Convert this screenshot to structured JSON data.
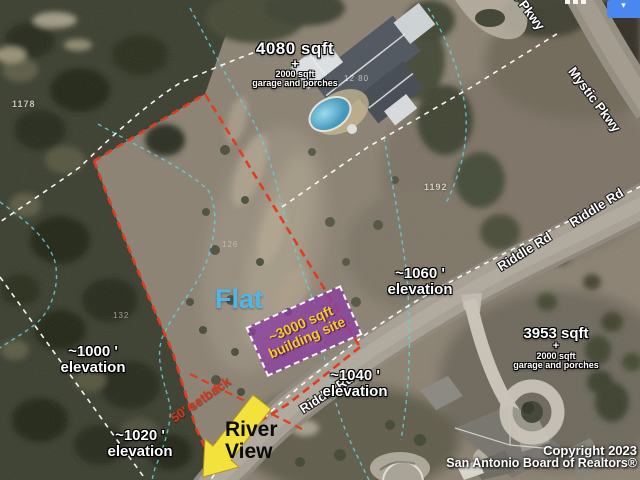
{
  "map": {
    "area_labels": {
      "north_house": {
        "sqft": "4080 sqft",
        "plus": "+",
        "extra1": "2000 sqft",
        "extra2": "garage and porches"
      },
      "south_house": {
        "sqft": "3953 sqft",
        "plus": "+",
        "extra1": "2000 sqft",
        "extra2": "garage and porches"
      }
    },
    "site_labels": {
      "flat": "Flat",
      "building_site_line1": "~3000 sqft",
      "building_site_line2": "building site",
      "setback": "50' setback",
      "river_view_line1": "River",
      "river_view_line2": "View"
    },
    "elevation_labels": {
      "e1060": {
        "value": "~1060 '",
        "word": "elevation"
      },
      "e1040": {
        "value": "~1040 '",
        "word": "elevation"
      },
      "e1000": {
        "value": "~1000 '",
        "word": "elevation"
      },
      "e1020": {
        "value": "~1020 '",
        "word": "elevation"
      }
    },
    "parcel_numbers": {
      "p1178": "1178",
      "p1192": "1192",
      "p126": "126",
      "p132": "132"
    },
    "house_number": "12 80",
    "road_labels": {
      "riddle1": "Riddle Rd",
      "riddle2": "Riddle Rd",
      "riddle3": "Riddle Rd",
      "mystic1": "Mystic Pkwy",
      "mystic2": "Mystic Pkwy"
    },
    "copyright": {
      "line1": "Copyright 2023",
      "line2": "San Antonio Board of Realtors®"
    },
    "colors": {
      "boundary_red": "#e63a1e",
      "contour_cyan": "#62d2e2",
      "building_site_purple": "#8e3ea4",
      "building_site_text": "#f2cf1f",
      "arrow_yellow": "#f3e23c",
      "flat_blue": "#4db7e8",
      "button_blue": "#4a87f0"
    }
  }
}
